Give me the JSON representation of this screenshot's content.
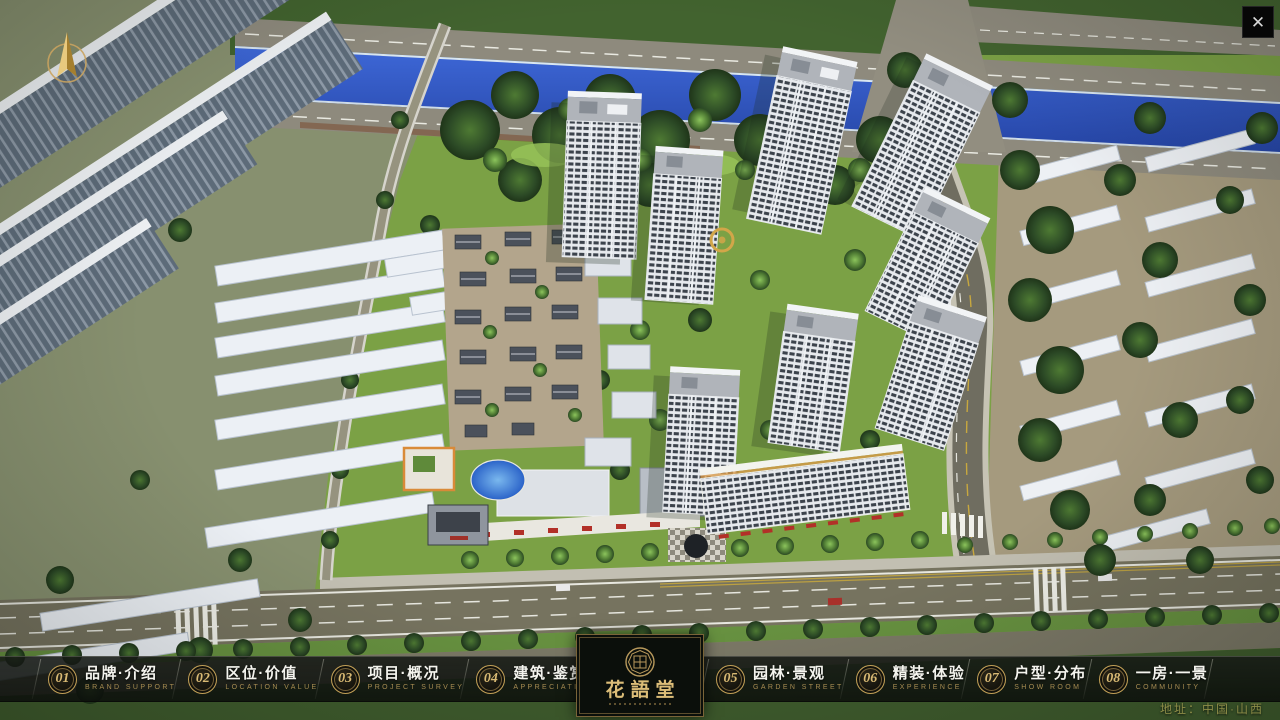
{
  "icons": {
    "close": "✕",
    "compass": "north-arrow"
  },
  "colors": {
    "accent_gold": "#c2a057",
    "nav_bg": "#10140f",
    "nav_text": "#f4f4ee",
    "nav_subtitle": "#a78c52",
    "logo_gold": "#dcbd78",
    "address_text": "#8d8d48",
    "river_blue": "#2f55c2",
    "grass_green": "#7ba145"
  },
  "nav": {
    "items": [
      {
        "num": "01",
        "zh": "品牌·介绍",
        "en": "BRAND SUPPORT"
      },
      {
        "num": "02",
        "zh": "区位·价值",
        "en": "LOCATION VALUE"
      },
      {
        "num": "03",
        "zh": "项目·概况",
        "en": "PROJECT SURVEY"
      },
      {
        "num": "04",
        "zh": "建筑·鉴赏",
        "en": "APPRECIATION"
      },
      {
        "num": "05",
        "zh": "园林·景观",
        "en": "GARDEN STREET"
      },
      {
        "num": "06",
        "zh": "精装·体验",
        "en": "EXPERIENCE"
      },
      {
        "num": "07",
        "zh": "户型·分布",
        "en": "SHOW ROOM"
      },
      {
        "num": "08",
        "zh": "一房·一景",
        "en": "COMMUNITY"
      }
    ],
    "logo": {
      "title": "花語堂"
    }
  },
  "footer": {
    "address": "地址：中国·山西"
  }
}
